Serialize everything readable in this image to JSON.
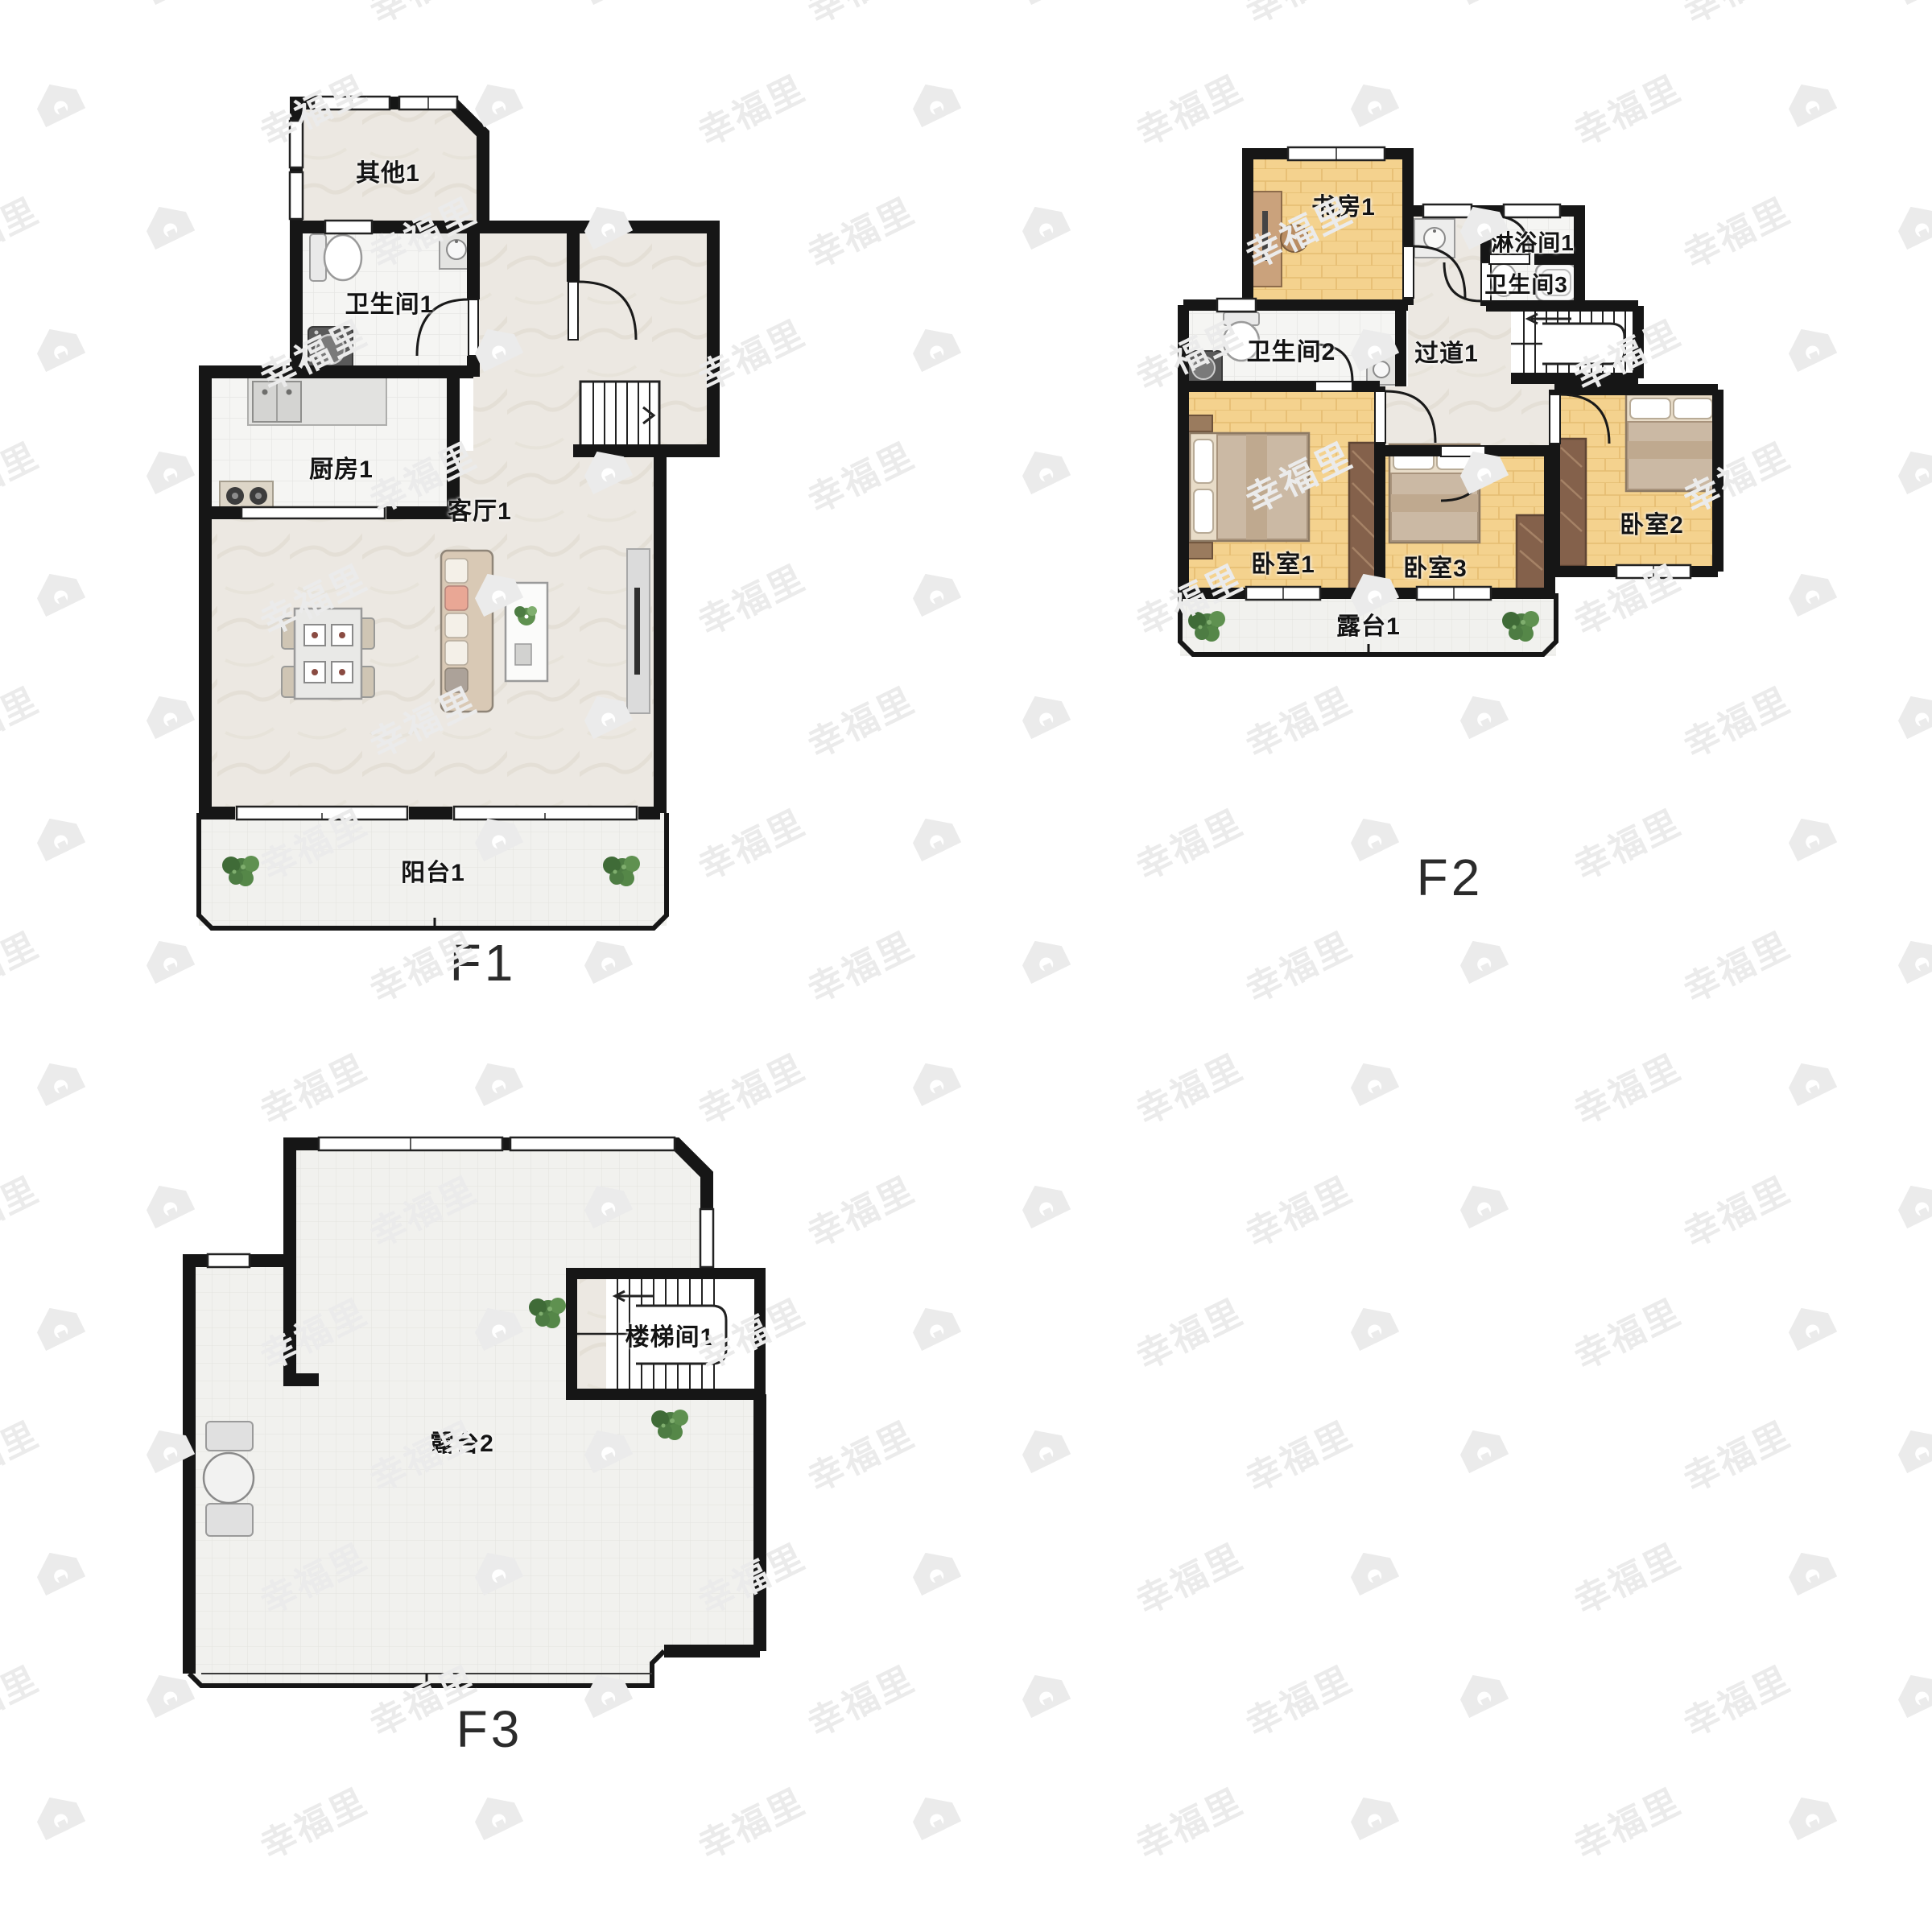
{
  "watermark": {
    "text": "幸福里",
    "icon": "house-logo-icon",
    "color": "#ebebeb"
  },
  "floors": [
    {
      "label": "F1",
      "rooms": [
        {
          "name": "其他1"
        },
        {
          "name": "卫生间1"
        },
        {
          "name": "厨房1"
        },
        {
          "name": "客厅1"
        },
        {
          "name": "阳台1"
        }
      ]
    },
    {
      "label": "F2",
      "rooms": [
        {
          "name": "书房1"
        },
        {
          "name": "淋浴间1"
        },
        {
          "name": "卫生间3"
        },
        {
          "name": "卫生间2"
        },
        {
          "name": "过道1"
        },
        {
          "name": "卧室1"
        },
        {
          "name": "卧室3"
        },
        {
          "name": "卧室2"
        },
        {
          "name": "露台1"
        }
      ]
    },
    {
      "label": "F3",
      "rooms": [
        {
          "name": "楼梯间1"
        },
        {
          "name": "露台2"
        }
      ]
    }
  ],
  "palette": {
    "wall": "#161616",
    "marble_floor": "#ece8e2",
    "tile_floor": "#f5f5f3",
    "wood_floor": "#f4d28e",
    "terrace_floor": "#f1f1ee",
    "wardrobe": "#84614b",
    "sofa": "#d9c9b5",
    "accent_pillow": "#e9a795",
    "plant": "#4d7c43"
  }
}
